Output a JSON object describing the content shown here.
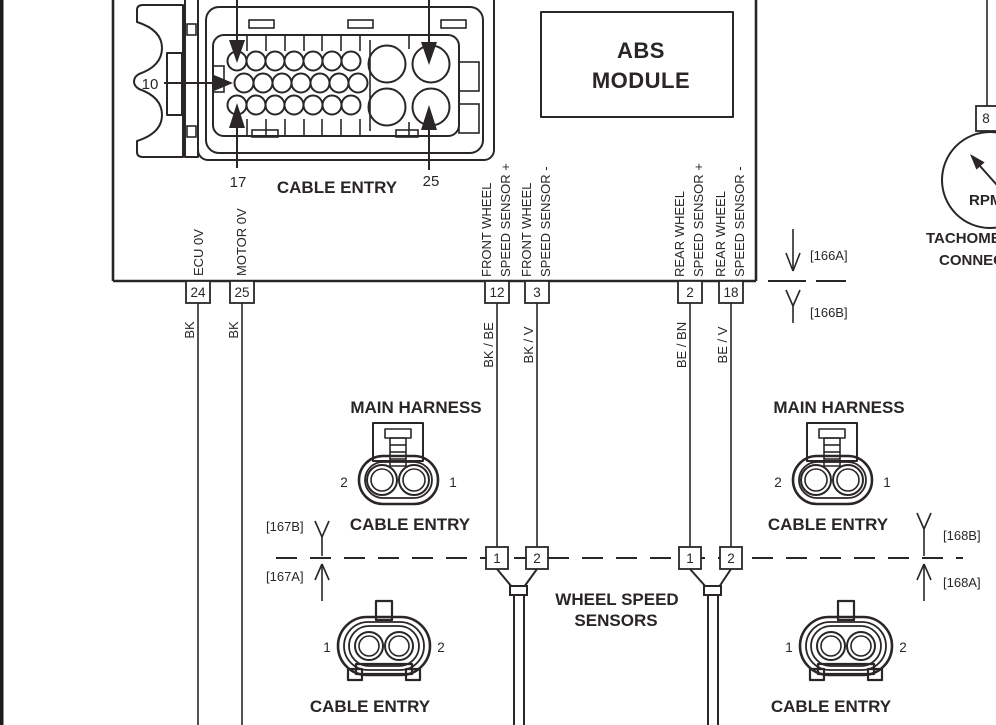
{
  "colors": {
    "ink": "#2a2627",
    "paper": "#ffffff"
  },
  "diagram": {
    "abs_module": {
      "line1": "ABS",
      "line2": "MODULE"
    },
    "connector_face": {
      "pin10": "10",
      "pin17": "17",
      "pin25": "25",
      "cable_entry": "CABLE ENTRY"
    },
    "module_pins": [
      {
        "pin": "24",
        "signal1": "ECU 0V",
        "wire": "BK"
      },
      {
        "pin": "25",
        "signal1": "MOTOR 0V",
        "wire": "BK"
      },
      {
        "pin": "12",
        "signal1": "FRONT WHEEL",
        "signal2": "SPEED SENSOR +",
        "wire": "BK / BE"
      },
      {
        "pin": "3",
        "signal1": "FRONT WHEEL",
        "signal2": "SPEED SENSOR -",
        "wire": "BK / V"
      },
      {
        "pin": "2",
        "signal1": "REAR WHEEL",
        "signal2": "SPEED SENSOR +",
        "wire": "BE / BN"
      },
      {
        "pin": "18",
        "signal1": "REAR WHEEL",
        "signal2": "SPEED SENSOR -",
        "wire": "BE / V"
      }
    ],
    "connectors": {
      "c166a": "[166A]",
      "c166b": "[166B]",
      "c167a": "[167A]",
      "c167b": "[167B]",
      "c168a": "[168A]",
      "c168b": "[168B]"
    },
    "tachometer": {
      "pin": "8",
      "gauge": "RPM",
      "name1": "TACHOMETER",
      "name2": "CONNECTOR"
    },
    "front_harness": {
      "title": "MAIN HARNESS",
      "left": "2",
      "right": "1",
      "cable_entry": "CABLE ENTRY"
    },
    "rear_harness": {
      "title": "MAIN HARNESS",
      "left": "2",
      "right": "1",
      "cable_entry": "CABLE ENTRY"
    },
    "front_splice": {
      "p1": "1",
      "p2": "2"
    },
    "rear_splice": {
      "p1": "1",
      "p2": "2"
    },
    "sensors_label": {
      "line1": "WHEEL SPEED",
      "line2": "SENSORS"
    },
    "front_sensor": {
      "left": "1",
      "right": "2",
      "cable_entry": "CABLE ENTRY"
    },
    "rear_sensor": {
      "left": "1",
      "right": "2",
      "cable_entry": "CABLE ENTRY"
    }
  }
}
